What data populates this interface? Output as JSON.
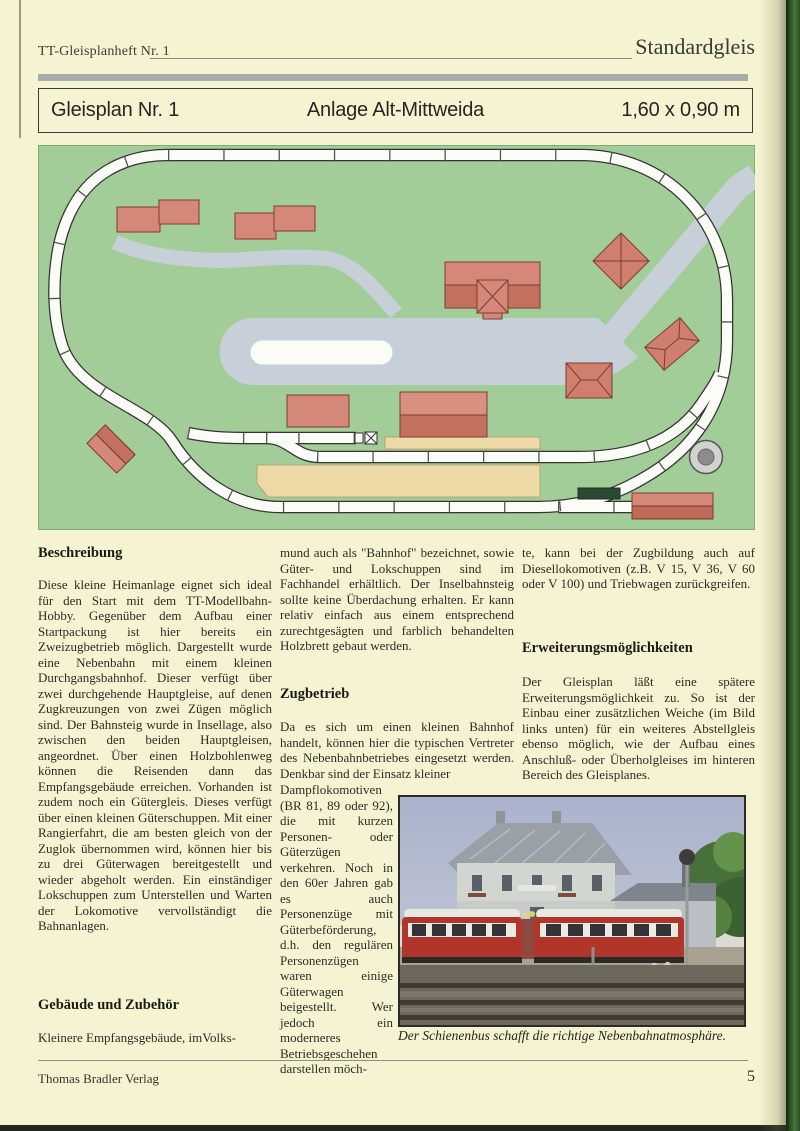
{
  "page": {
    "header": {
      "left": "TT-Gleisplanheft Nr. 1",
      "right": "Standardgleis"
    },
    "title_bar": {
      "plan_number": "Gleisplan Nr. 1",
      "layout_name": "Anlage Alt-Mittweida",
      "dimensions": "1,60 x 0,90 m"
    },
    "footer": {
      "publisher": "Thomas Bradler Verlag",
      "page_number": "5"
    }
  },
  "article": {
    "col1": {
      "heading1": "Beschreibung",
      "para1": "Diese kleine Heimanlage eignet sich ideal für den Start mit dem TT-Modellbahn-Hobby. Gegenüber dem Aufbau einer Startpackung ist hier bereits ein Zweizugbetrieb möglich. Dargestellt wurde eine Nebenbahn mit einem kleinen Durchgangsbahnhof. Dieser verfügt über zwei durchgehende Hauptgleise, auf denen Zugkreuzungen von zwei Zügen möglich sind. Der Bahnsteig wurde in Insellage, also zwischen den beiden Hauptgleisen, angeordnet. Über einen Holzbohlenweg können die Reisenden dann das Empfangsgebäude erreichen. Vorhanden ist zudem noch ein Gütergleis. Dieses verfügt über einen kleinen Güterschuppen. Mit einer Rangierfahrt, die am besten gleich von der Zuglok übernommen wird, können hier bis zu drei Güterwagen bereitgestellt und wieder abgeholt werden. Ein einständiger Lokschuppen zum Unterstellen und Warten der Lokomotive vervollständigt die Bahnanlagen.",
      "heading2": "Gebäude und Zubehör",
      "para2": "Kleinere Empfangsgebäude, imVolks-"
    },
    "col2": {
      "para1": "mund auch als \"Bahnhof\" bezeichnet, sowie Güter- und Lokschuppen sind im Fachhandel erhältlich. Der Inselbahnsteig sollte keine Überdachung erhalten. Er kann relativ einfach aus einem entsprechend zurechtgesägten und farblich behandelten Holzbrett gebaut werden.",
      "heading": "Zugbetrieb",
      "para2": "Da es sich um einen kleinen Bahnhof handelt, können hier die typischen Vertreter des Nebenbahnbetriebes eingesetzt werden. Denkbar sind der Einsatz kleiner",
      "para3": "Dampflokomotiven (BR 81, 89 oder 92), die mit kurzen Personen- oder Güterzügen verkehren. Noch in den 60er Jahren gab es auch Personenzüge mit Güterbeförderung, d.h. den regulären Personenzügen waren einige Güterwagen beigestellt. Wer jedoch ein moderneres Betriebsgeschehen darstellen möch-"
    },
    "col3": {
      "para1": "te, kann bei der Zugbildung auch auf Diesellokomotiven (z.B. V 15, V 36, V 60 oder V 100) und Triebwagen zurückgreifen.",
      "heading": "Erweiterungsmöglichkeiten",
      "para2": "Der Gleisplan läßt eine spätere Erweiterungsmöglichkeit zu. So ist der Einbau einer zusätzlichen Weiche (im Bild links unten) für ein weiteres Abstellgleis ebenso möglich, wie der Aufbau eines Anschluß- oder Überholgleises im hinteren Bereich des Gleisplanes."
    },
    "photo_caption": "Der Schienenbus schafft die richtige Nebenbahnatmosphäre."
  },
  "colors": {
    "page_background": "#f6f3d2",
    "board_green": "#a3cd98",
    "building_salmon": "#d58878",
    "building_outline": "#8a4034",
    "road_gray": "#c7d0d8",
    "platform_tan": "#ecd9a6",
    "track_white": "#fbfbf8",
    "spine_green": "#2b5124"
  }
}
